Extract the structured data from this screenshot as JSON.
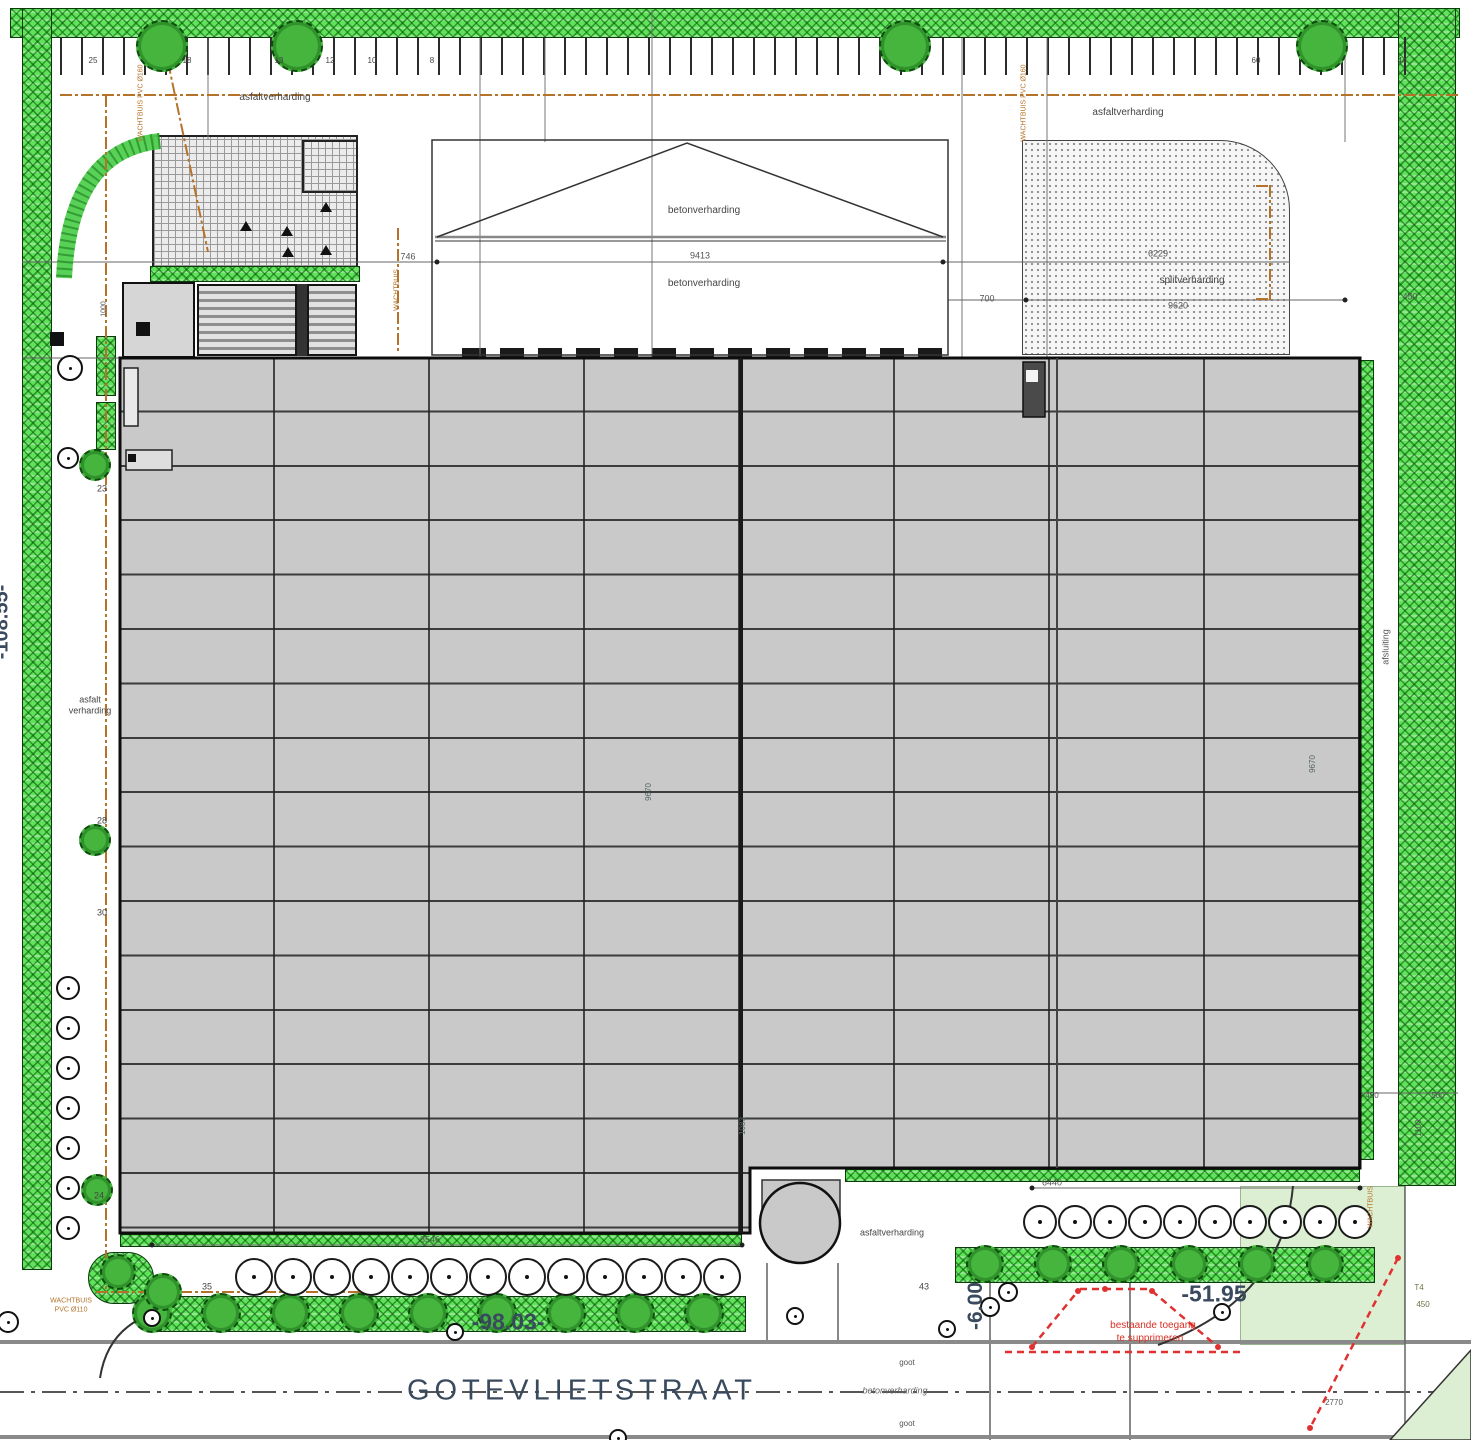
{
  "street": {
    "name": "GOTEVLIETSTRAAT",
    "dim_left": "-98.03-",
    "dim_right": "-51.95",
    "dim_entry": "-6.00"
  },
  "site": {
    "left_boundary_dim": "-108.55-"
  },
  "colors": {
    "green_strip": "#5fe35a",
    "building_roof": "#c9c9c9",
    "light_green": "#dcefd2",
    "utility_brown": "#b5732a",
    "alert_red": "#e03030",
    "dim_text": "#3a4a5e"
  },
  "annotations": [
    {
      "n": "label-asphalt-top-left",
      "t": "asfaltverharding",
      "x": 275,
      "y": 98,
      "s": 10
    },
    {
      "n": "label-asphalt-top-right",
      "t": "asfaltverharding",
      "x": 1128,
      "y": 113,
      "s": 10
    },
    {
      "n": "label-concrete-upper",
      "t": "betonverharding",
      "x": 704,
      "y": 211,
      "s": 10
    },
    {
      "n": "label-concrete-lower",
      "t": "betonverharding",
      "x": 704,
      "y": 284,
      "s": 10
    },
    {
      "n": "label-gravel",
      "t": "splitverharding",
      "x": 1192,
      "y": 281,
      "s": 10
    },
    {
      "n": "label-asphalt-bottom",
      "t": "asfaltverharding",
      "x": 892,
      "y": 1233,
      "s": 9
    },
    {
      "n": "dim-9413",
      "t": "9413",
      "x": 700,
      "y": 256,
      "s": 9,
      "c": "#555"
    },
    {
      "n": "dim-746",
      "t": "746",
      "x": 408,
      "y": 257,
      "s": 9,
      "c": "#555"
    },
    {
      "n": "dim-700",
      "t": "700",
      "x": 987,
      "y": 299,
      "s": 9,
      "c": "#555"
    },
    {
      "n": "dim-6229",
      "t": "6229",
      "x": 1158,
      "y": 254,
      "s": 9,
      "c": "#555"
    },
    {
      "n": "dim-9620",
      "t": "9620",
      "x": 1178,
      "y": 306,
      "s": 9,
      "c": "#555"
    },
    {
      "n": "dim-450-top-right",
      "t": "450",
      "x": 1410,
      "y": 297,
      "s": 9,
      "c": "#555"
    },
    {
      "n": "dim-450-right",
      "t": "450",
      "x": 1372,
      "y": 1096,
      "s": 8,
      "c": "#555"
    },
    {
      "n": "dim-500-right",
      "t": "500",
      "x": 1438,
      "y": 1096,
      "s": 8,
      "c": "#555"
    },
    {
      "n": "dim-1100-right",
      "t": "1100",
      "x": 1419,
      "y": 1128,
      "s": 8,
      "r": -90,
      "c": "#555"
    },
    {
      "n": "note-line1",
      "t": "bestaande toegang",
      "x": 1153,
      "y": 1326,
      "s": 10,
      "c": "#d93025"
    },
    {
      "n": "note-line2",
      "t": "te supprimeren",
      "x": 1150,
      "y": 1339,
      "s": 10,
      "c": "#d93025"
    },
    {
      "n": "label-fence",
      "t": "afsluiting",
      "x": 1386,
      "y": 647,
      "s": 9,
      "r": -90,
      "c": "#555"
    },
    {
      "n": "label-asphalt-left-1",
      "t": "asfalt",
      "x": 90,
      "y": 700,
      "s": 9
    },
    {
      "n": "label-asphalt-left-2",
      "t": "verharding",
      "x": 90,
      "y": 711,
      "s": 9
    },
    {
      "n": "label-concrete-street",
      "t": "betonverharding",
      "x": 895,
      "y": 1391,
      "s": 9,
      "c": "#666",
      "i": 1
    },
    {
      "n": "label-gutter-1",
      "t": "goot",
      "x": 907,
      "y": 1363,
      "s": 8,
      "c": "#555"
    },
    {
      "n": "label-gutter-2",
      "t": "goot",
      "x": 907,
      "y": 1424,
      "s": 8,
      "c": "#555"
    },
    {
      "n": "dim-8546",
      "t": "8546",
      "x": 430,
      "y": 1240,
      "s": 9,
      "c": "#555"
    },
    {
      "n": "dim-6440",
      "t": "6440",
      "x": 1052,
      "y": 1183,
      "s": 9,
      "c": "#555"
    },
    {
      "n": "dim-9670-left",
      "t": "9670",
      "x": 649,
      "y": 792,
      "s": 8,
      "r": -90,
      "c": "#566"
    },
    {
      "n": "dim-9670-right",
      "t": "9670",
      "x": 1313,
      "y": 764,
      "s": 8,
      "r": -90,
      "c": "#566"
    },
    {
      "n": "dim-1083",
      "t": "1083",
      "x": 743,
      "y": 1126,
      "s": 8,
      "r": -90,
      "c": "#566"
    },
    {
      "n": "num-23",
      "t": "23",
      "x": 102,
      "y": 489,
      "s": 9
    },
    {
      "n": "num-28",
      "t": "28",
      "x": 102,
      "y": 821,
      "s": 9
    },
    {
      "n": "num-30",
      "t": "30",
      "x": 102,
      "y": 913,
      "s": 9
    },
    {
      "n": "num-24",
      "t": "24",
      "x": 99,
      "y": 1196,
      "s": 9
    },
    {
      "n": "num-35",
      "t": "35",
      "x": 207,
      "y": 1287,
      "s": 9
    },
    {
      "n": "num-43",
      "t": "43",
      "x": 924,
      "y": 1287,
      "s": 9
    },
    {
      "n": "pnum-25",
      "t": "25",
      "x": 93,
      "y": 61,
      "s": 8
    },
    {
      "n": "pnum-18",
      "t": "18",
      "x": 187,
      "y": 61,
      "s": 8
    },
    {
      "n": "pnum-13",
      "t": "13",
      "x": 279,
      "y": 61,
      "s": 8
    },
    {
      "n": "pnum-12",
      "t": "12",
      "x": 330,
      "y": 61,
      "s": 8
    },
    {
      "n": "pnum-10",
      "t": "10",
      "x": 372,
      "y": 61,
      "s": 8
    },
    {
      "n": "pnum-8",
      "t": "8",
      "x": 432,
      "y": 61,
      "s": 8
    },
    {
      "n": "pnum-60",
      "t": "60",
      "x": 1256,
      "y": 61,
      "s": 8
    },
    {
      "n": "pnum-44",
      "t": "44",
      "x": 1402,
      "y": 61,
      "s": 8
    },
    {
      "n": "dim-1000",
      "t": "1000",
      "x": 104,
      "y": 309,
      "s": 7,
      "r": -90,
      "c": "#555"
    },
    {
      "n": "label-conduit-topleft",
      "t": "WACHTBUIS PVC Ø160",
      "x": 141,
      "y": 103,
      "s": 7,
      "r": -90,
      "c": "#b5732a"
    },
    {
      "n": "label-conduit-topright",
      "t": "WACHTBUIS PVC Ø160",
      "x": 1024,
      "y": 103,
      "s": 7,
      "r": -90,
      "c": "#b5732a"
    },
    {
      "n": "label-conduit-mid",
      "t": "WACHTBUIS",
      "x": 397,
      "y": 290,
      "s": 7,
      "r": -90,
      "c": "#b5732a"
    },
    {
      "n": "label-conduit-bl-1",
      "t": "WACHTBUIS",
      "x": 71,
      "y": 1301,
      "s": 7,
      "c": "#b5732a"
    },
    {
      "n": "label-conduit-bl-2",
      "t": "PVC Ø110",
      "x": 71,
      "y": 1310,
      "s": 7,
      "c": "#b5732a"
    },
    {
      "n": "label-conduit-br",
      "t": "WACHTBUIS",
      "x": 1371,
      "y": 1207,
      "s": 7,
      "r": -90,
      "c": "#b5732a"
    },
    {
      "n": "label-t4",
      "t": "T4",
      "x": 1419,
      "y": 1288,
      "s": 8,
      "c": "#667744"
    },
    {
      "n": "dim-450-corner",
      "t": "450",
      "x": 1423,
      "y": 1305,
      "s": 8,
      "c": "#667744"
    },
    {
      "n": "dim-2770",
      "t": "2770",
      "x": 1334,
      "y": 1403,
      "s": 8,
      "c": "#555"
    }
  ],
  "features": {
    "trees_top": {
      "y": 46,
      "r": 26,
      "x": [
        162,
        297,
        905,
        1322
      ]
    },
    "trees_left": [
      {
        "x": 95,
        "y": 465,
        "r": 16
      },
      {
        "x": 95,
        "y": 840,
        "r": 16
      },
      {
        "x": 97,
        "y": 1190,
        "r": 16
      }
    ],
    "strip_trees_left": {
      "y": 1313,
      "r": 20,
      "x": [
        152,
        221,
        290,
        359,
        428,
        497,
        566,
        635,
        704
      ]
    },
    "strip_trees_corner": [
      {
        "x": 118,
        "y": 1272,
        "r": 18
      },
      {
        "x": 163,
        "y": 1292,
        "r": 19
      }
    ],
    "strip_trees_right": {
      "y": 1264,
      "r": 19,
      "x": [
        985,
        1053,
        1121,
        1189,
        1257,
        1325
      ]
    },
    "plant_circles_left": {
      "y": 1277,
      "r": 19,
      "x": [
        254,
        293,
        332,
        371,
        410,
        449,
        488,
        527,
        566,
        605,
        644,
        683,
        722
      ]
    },
    "plant_circles_right": {
      "y": 1222,
      "r": 17,
      "x": [
        1040,
        1075,
        1110,
        1145,
        1180,
        1215,
        1250,
        1285,
        1320,
        1355
      ]
    },
    "manholes": [
      {
        "x": 70,
        "y": 368,
        "r": 13
      },
      {
        "x": 68,
        "y": 458,
        "r": 11
      },
      {
        "x": 68,
        "y": 988,
        "r": 12
      },
      {
        "x": 68,
        "y": 1028,
        "r": 12
      },
      {
        "x": 68,
        "y": 1068,
        "r": 12
      },
      {
        "x": 68,
        "y": 1108,
        "r": 12
      },
      {
        "x": 68,
        "y": 1148,
        "r": 12
      },
      {
        "x": 68,
        "y": 1188,
        "r": 12
      },
      {
        "x": 68,
        "y": 1228,
        "r": 12
      },
      {
        "x": 8,
        "y": 1322,
        "r": 11
      },
      {
        "x": 152,
        "y": 1318,
        "r": 9
      },
      {
        "x": 455,
        "y": 1332,
        "r": 9
      },
      {
        "x": 795,
        "y": 1316,
        "r": 9
      },
      {
        "x": 947,
        "y": 1329,
        "r": 9
      },
      {
        "x": 1222,
        "y": 1312,
        "r": 9
      },
      {
        "x": 618,
        "y": 1438,
        "r": 9
      },
      {
        "x": 1008,
        "y": 1292,
        "r": 10
      },
      {
        "x": 990,
        "y": 1307,
        "r": 10
      }
    ]
  }
}
